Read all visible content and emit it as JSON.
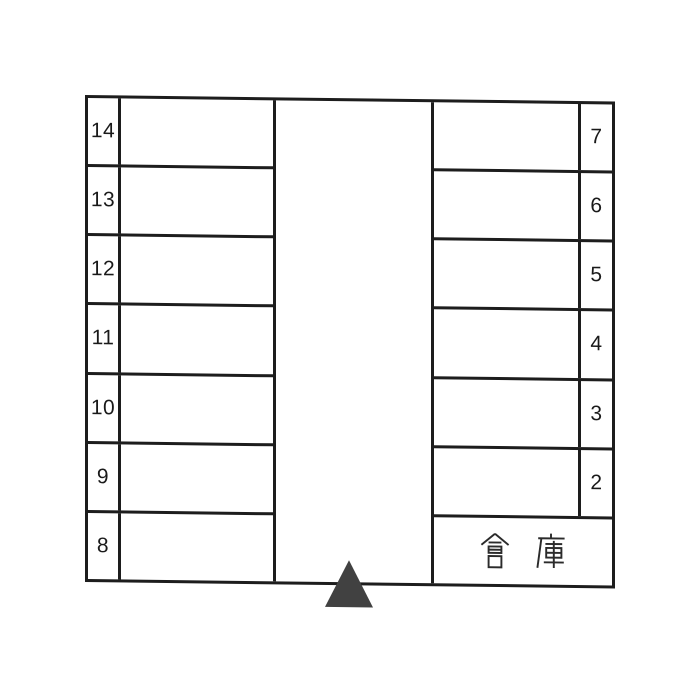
{
  "diagram": {
    "type": "parking-lot-layout",
    "left_column": {
      "stalls": [
        {
          "label": "14"
        },
        {
          "label": "13"
        },
        {
          "label": "12"
        },
        {
          "label": "11"
        },
        {
          "label": "10"
        },
        {
          "label": "9"
        },
        {
          "label": "8"
        }
      ]
    },
    "right_column": {
      "stalls": [
        {
          "label": "7"
        },
        {
          "label": "6"
        },
        {
          "label": "5"
        },
        {
          "label": "4"
        },
        {
          "label": "3"
        },
        {
          "label": "2"
        }
      ]
    },
    "storage": {
      "label": "倉 庫"
    },
    "entrance": {
      "icon": "filled-triangle",
      "color": "#414141"
    },
    "colors": {
      "line": "#1d1d1d",
      "text": "#1a1a1a",
      "background": "#ffffff",
      "triangle": "#414141"
    }
  }
}
